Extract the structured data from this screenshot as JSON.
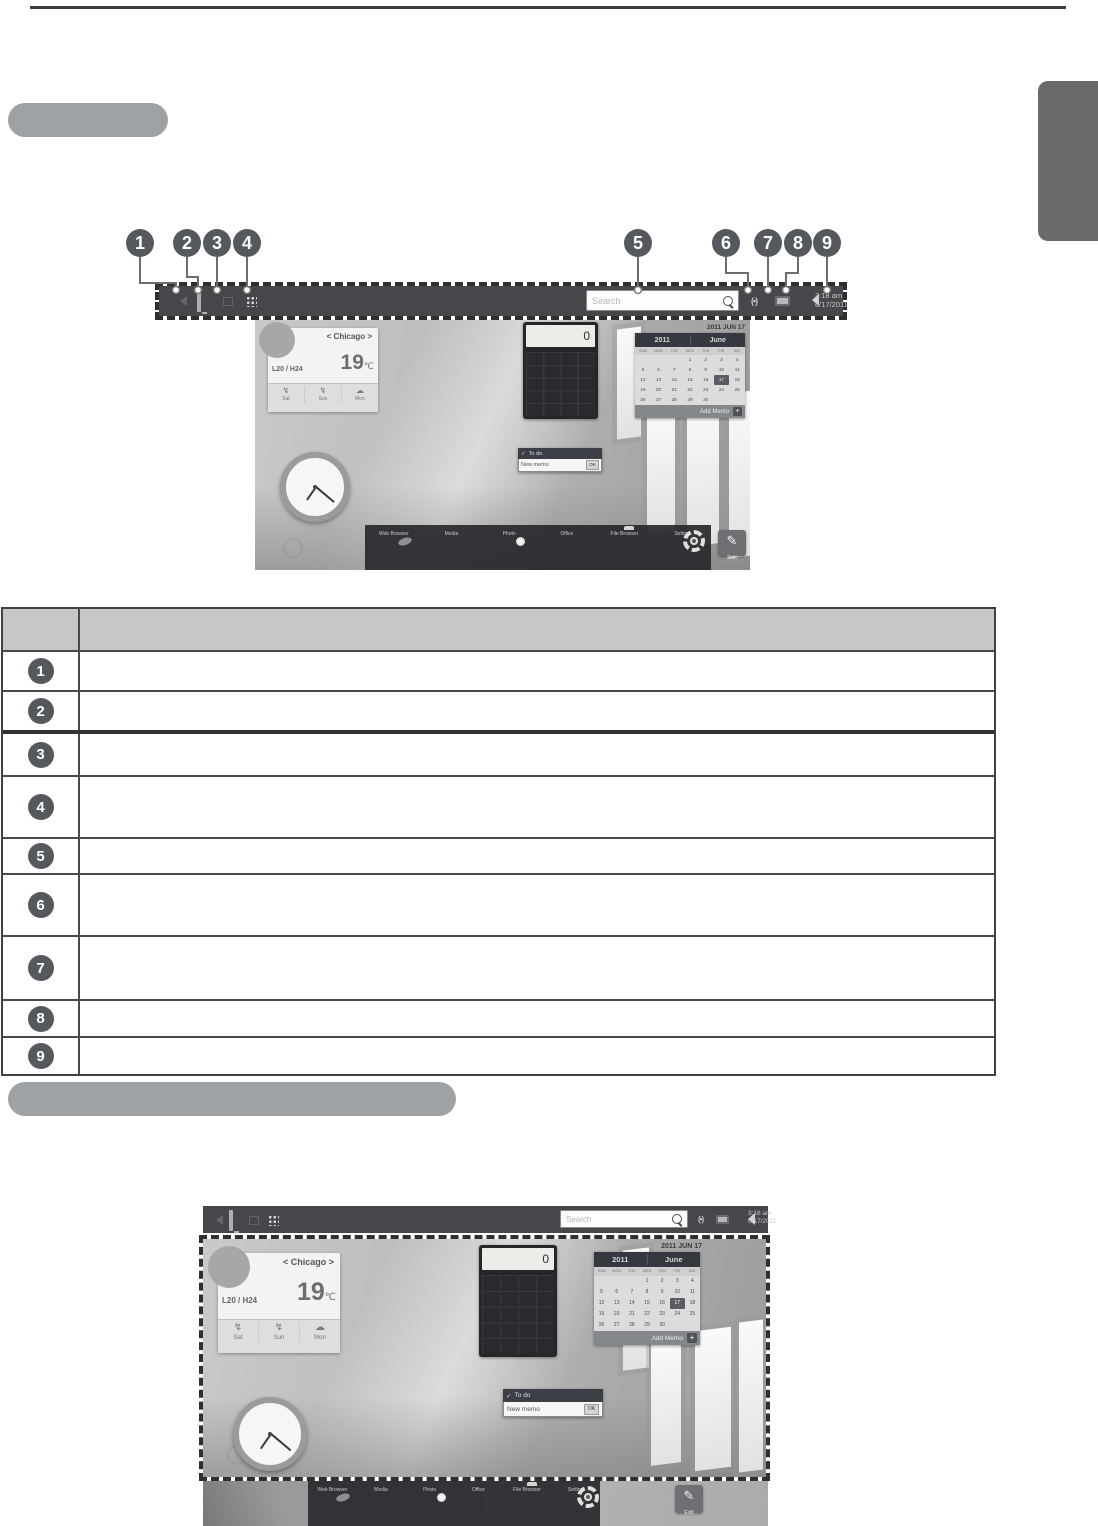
{
  "callouts": [
    "1",
    "2",
    "3",
    "4",
    "5",
    "6",
    "7",
    "8",
    "9"
  ],
  "toolbar": {
    "search_placeholder": "Search",
    "time": "3:18 am",
    "date": "6/17/2011",
    "icons": {
      "signal": "(•)"
    }
  },
  "desktop": {
    "weather": {
      "city": "< Chicago >",
      "range": "L20 / H24",
      "temp": "19",
      "unit": "℃",
      "day_icons": [
        "↯",
        "↯",
        "☁"
      ],
      "days": [
        "Sat",
        "Sun",
        "Mon"
      ]
    },
    "calculator": {
      "display": "0"
    },
    "calendar": {
      "date_label": "2011 JUN 17",
      "year": "2011",
      "month": "June",
      "day_headers": [
        "SUN",
        "MON",
        "TUE",
        "WED",
        "THU",
        "FRI",
        "SAT"
      ],
      "cells": [
        "",
        "",
        "",
        "1",
        "2",
        "3",
        "4",
        "5",
        "6",
        "7",
        "8",
        "9",
        "10",
        "11",
        "12",
        "13",
        "14",
        "15",
        "16",
        {
          "t": "17",
          "c": "sel"
        },
        "18",
        "19",
        "20",
        "21",
        "22",
        "23",
        "24",
        "25",
        "26",
        "27",
        "28",
        "29",
        "30",
        "",
        ""
      ],
      "footer": "Add Memo",
      "plus": "+"
    },
    "todo": {
      "check": "✓",
      "title": "To do",
      "item": "New memo",
      "ok": "OK"
    },
    "dock": [
      "Web Browser",
      "Media",
      "Photo",
      "Office",
      "File Browser",
      "Setting"
    ],
    "edit": {
      "glyph": "✎",
      "label": "Edit"
    }
  },
  "table": {
    "header_label": "",
    "rows": [
      "",
      "",
      "",
      "",
      "",
      "",
      "",
      "",
      ""
    ]
  }
}
